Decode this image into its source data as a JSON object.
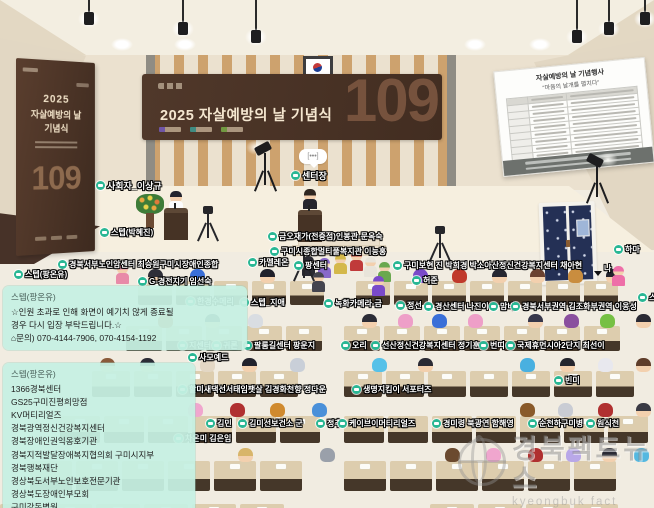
{
  "scene_title": "2025 자살예방의 날 기념식 가상 행사장",
  "banner": {
    "title": "2025 자살예방의 날 기념식",
    "number": "109",
    "logo_colors": [
      "#7a5fd0",
      "#3aa8a0",
      "#7fba4a"
    ]
  },
  "poster": {
    "year": "2025",
    "line2": "자살예방의 날",
    "line3": "기념식",
    "number": "109"
  },
  "schedule_board": {
    "title": "자살예방의 날 기념행사",
    "subtitle": "“마음의 날개를 펼치다”",
    "row_count": 9
  },
  "stage": {
    "voice_indicator": "[•••]"
  },
  "labels": [
    {
      "t": "사회자_이상규",
      "x": 96,
      "y": 179,
      "s": 9
    },
    {
      "t": "센터장",
      "x": 291,
      "y": 169,
      "s": 9
    },
    {
      "t": "스텝(박혜진)",
      "x": 100,
      "y": 227
    },
    {
      "t": "금오재가(전증점)인봉관-문옥숙",
      "x": 268,
      "y": 231
    },
    {
      "t": "구미시종합멀티풀복지관 이능홍",
      "x": 270,
      "y": 246
    },
    {
      "t": "경북서부노인암센터 최승원구미시장애인종합",
      "x": 58,
      "y": 259
    },
    {
      "t": "카멜레온",
      "x": 248,
      "y": 257
    },
    {
      "t": "팡센터",
      "x": 294,
      "y": 260
    },
    {
      "t": "스텝(팡온유)",
      "x": 14,
      "y": 269
    },
    {
      "t": "G-경전지기 임선숙",
      "x": 138,
      "y": 276
    },
    {
      "t": "구미보현 진 박희경 박소아산정신건강복지센터 채아현",
      "x": 393,
      "y": 260
    },
    {
      "t": "허준",
      "x": 412,
      "y": 275
    },
    {
      "t": "하마",
      "x": 614,
      "y": 244
    },
    {
      "t": "나",
      "x": 604,
      "y": 263,
      "ni": true
    },
    {
      "t": "스텝(",
      "x": 638,
      "y": 292
    },
    {
      "t": "한경수메리",
      "x": 186,
      "y": 296
    },
    {
      "t": "스텝_지애",
      "x": 240,
      "y": 297
    },
    {
      "t": "녹화카메라-금",
      "x": 324,
      "y": 298
    },
    {
      "t": "정선",
      "x": 396,
      "y": 300
    },
    {
      "t": "경산센터 나진이",
      "x": 424,
      "y": 301
    },
    {
      "t": "맘비",
      "x": 489,
      "y": 301
    },
    {
      "t": "경북서부권역 김조화부권역 이웅성",
      "x": 511,
      "y": 301
    },
    {
      "t": "지센터",
      "x": 178,
      "y": 340
    },
    {
      "t": "귀론",
      "x": 212,
      "y": 340
    },
    {
      "t": "팔룸길센터 팡운지",
      "x": 243,
      "y": 340
    },
    {
      "t": "오리",
      "x": 341,
      "y": 340
    },
    {
      "t": "선산정신건강복지센터 정기훈",
      "x": 371,
      "y": 340
    },
    {
      "t": "번띠",
      "x": 479,
      "y": 340
    },
    {
      "t": "국제휴먼시아2단지 최선이",
      "x": 506,
      "y": 340
    },
    {
      "t": "사모예드",
      "x": 188,
      "y": 352
    },
    {
      "t": "할미새댁선서태임팻살 김경화천향 정다운",
      "x": 178,
      "y": 384
    },
    {
      "t": "생명지킴이 서포터즈",
      "x": 352,
      "y": 384
    },
    {
      "t": "빈미",
      "x": 554,
      "y": 375
    },
    {
      "t": "김민",
      "x": 206,
      "y": 418
    },
    {
      "t": "김미선보건소 군",
      "x": 238,
      "y": 418
    },
    {
      "t": "정추",
      "x": 316,
      "y": 418
    },
    {
      "t": "케이브이머티리얼즈",
      "x": 338,
      "y": 418
    },
    {
      "t": "경미령 북광연 함해영",
      "x": 432,
      "y": 418
    },
    {
      "t": "순천하구미병",
      "x": 528,
      "y": 418
    },
    {
      "t": "원식천",
      "x": 586,
      "y": 418
    },
    {
      "t": "차온미 김은임",
      "x": 174,
      "y": 433
    }
  ],
  "chat": {
    "bubbles": [
      {
        "sender": "스텝(팡온유)",
        "x": 3,
        "y": 286,
        "w": 228,
        "lines": [
          "☆인원 초과로 인해 화면이 예기치 않게 종료될",
          "경우 다시 입장 부탁드립니다.☆",
          "⌂문의) 070-4144-7906, 070-4154-1192"
        ]
      },
      {
        "sender": "스텝(팡온유)",
        "x": 3,
        "y": 363,
        "w": 176,
        "lines": [
          "1366경북센터",
          "GS25구미진평희망점",
          "KV머티리얼즈",
          "경북광역정신건강복지센터",
          "경북장애인권익옹호기관",
          "경북지적발달장애복지협의회 구미시지부",
          "경북행복재단",
          "경상북도서부노인보호전문기관",
          "경상북도장애인부모회",
          "구미강동병원..."
        ]
      }
    ]
  },
  "watermark": {
    "title": "경북팩트뉴스",
    "subtitle": "kyeongbuk fact news"
  },
  "ceiling": {
    "glows": [
      [
        122,
        38
      ],
      [
        185,
        38
      ],
      [
        475,
        38
      ],
      [
        540,
        38
      ]
    ],
    "lamps": [
      [
        84,
        12
      ],
      [
        178,
        22
      ],
      [
        251,
        30
      ],
      [
        640,
        12
      ],
      [
        604,
        22
      ],
      [
        572,
        30
      ]
    ]
  },
  "audience": {
    "desk_rows": [
      {
        "y": 281,
        "h": 24,
        "w": 34,
        "blocks": [
          [
            138,
            328
          ],
          [
            356,
            654
          ]
        ]
      },
      {
        "y": 326,
        "h": 25,
        "w": 36,
        "blocks": [
          [
            126,
            330
          ],
          [
            344,
            654
          ]
        ]
      },
      {
        "y": 371,
        "h": 26,
        "w": 38,
        "blocks": [
          [
            92,
            330
          ],
          [
            344,
            654
          ]
        ]
      },
      {
        "y": 416,
        "h": 27,
        "w": 40,
        "blocks": [
          [
            60,
            330
          ],
          [
            344,
            654
          ]
        ]
      },
      {
        "y": 461,
        "h": 30,
        "w": 42,
        "blocks": [
          [
            30,
            330
          ],
          [
            344,
            654
          ]
        ]
      },
      {
        "y": 504,
        "h": 28,
        "w": 44,
        "blocks": [
          [
            0,
            330
          ],
          [
            430,
            654
          ]
        ]
      }
    ],
    "seated": [
      {
        "y": 269,
        "list": [
          [
            148,
            "#2e2e38",
            0
          ],
          [
            190,
            "#3a6fd8",
            1
          ],
          [
            260,
            "#20202a",
            0
          ],
          [
            413,
            "#7a4ac9",
            1
          ],
          [
            452,
            "#c0392b",
            1
          ],
          [
            492,
            "#262630",
            0
          ],
          [
            530,
            "#6b4130",
            0
          ],
          [
            568,
            "#c98d3f",
            1
          ],
          [
            606,
            "#23232d",
            0
          ]
        ]
      },
      {
        "y": 314,
        "list": [
          [
            158,
            "#b1502a",
            1
          ],
          [
            205,
            "#23354a",
            0
          ],
          [
            248,
            "#d9dde2",
            1
          ],
          [
            362,
            "#2c2c36",
            0
          ],
          [
            398,
            "#ee9fc8",
            1
          ],
          [
            432,
            "#3a6fd8",
            1
          ],
          [
            468,
            "#ee9fc8",
            1
          ],
          [
            528,
            "#36364a",
            0
          ],
          [
            564,
            "#8a4f9e",
            1
          ],
          [
            600,
            "#76c043",
            1
          ],
          [
            636,
            "#2a2a34",
            0
          ]
        ]
      },
      {
        "y": 358,
        "list": [
          [
            100,
            "#8a5a3a",
            0
          ],
          [
            140,
            "#2c2c36",
            0
          ],
          [
            200,
            "#e3d7c4",
            1
          ],
          [
            242,
            "#22222c",
            0
          ],
          [
            290,
            "#c9cfd8",
            1
          ],
          [
            372,
            "#56c1e8",
            1
          ],
          [
            418,
            "#2a2a34",
            0
          ],
          [
            520,
            "#49b0e0",
            1
          ],
          [
            560,
            "#26262e",
            0
          ],
          [
            598,
            "#e8e8ee",
            1
          ],
          [
            636,
            "#5f3d2a",
            0
          ]
        ]
      },
      {
        "y": 403,
        "list": [
          [
            188,
            "#f0a6ce",
            1
          ],
          [
            230,
            "#b03030",
            1
          ],
          [
            270,
            "#d08a2e",
            1
          ],
          [
            312,
            "#4a90d9",
            1
          ],
          [
            520,
            "#8a5a2a",
            1
          ],
          [
            558,
            "#c9ccd4",
            1
          ],
          [
            598,
            "#b03030",
            1
          ],
          [
            636,
            "#3a3a44",
            0
          ]
        ]
      },
      {
        "y": 448,
        "list": [
          [
            238,
            "#d8b56a",
            0
          ],
          [
            320,
            "#9aa0aa",
            1
          ],
          [
            445,
            "#6b4a2f",
            1
          ],
          [
            486,
            "#f0a6ce",
            1
          ],
          [
            528,
            "#b03030",
            1
          ],
          [
            566,
            "#b9a8e8",
            1
          ],
          [
            602,
            "#2a2a34",
            0
          ],
          [
            634,
            "#55b8e0",
            1
          ]
        ]
      }
    ],
    "standing": [
      [
        302,
        256,
        "#2b2b33"
      ],
      [
        318,
        258,
        "#8868c9"
      ],
      [
        334,
        254,
        "#d4b84a"
      ],
      [
        350,
        251,
        "#c03a3a"
      ],
      [
        364,
        257,
        "#e8e4da"
      ],
      [
        378,
        262,
        "#6aa84f"
      ],
      [
        312,
        272,
        "#44444e"
      ],
      [
        372,
        276,
        "#7a4ac9"
      ],
      [
        612,
        266,
        "#ee6fa8"
      ],
      [
        116,
        264,
        "#e88aa8"
      ]
    ]
  }
}
